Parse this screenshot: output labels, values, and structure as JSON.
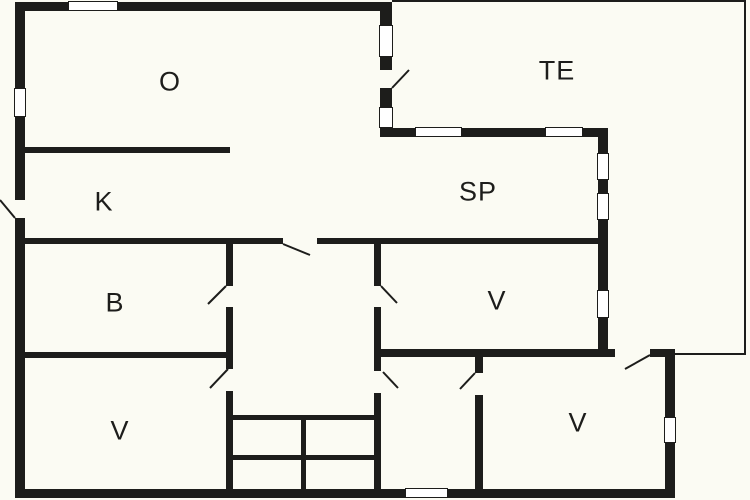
{
  "rooms": {
    "living": "O",
    "terrace": "TE",
    "kitchen": "K",
    "sp": "SP",
    "bath": "B",
    "v_bottom_left": "V",
    "v_middle": "V",
    "v_bottom_right": "V"
  }
}
